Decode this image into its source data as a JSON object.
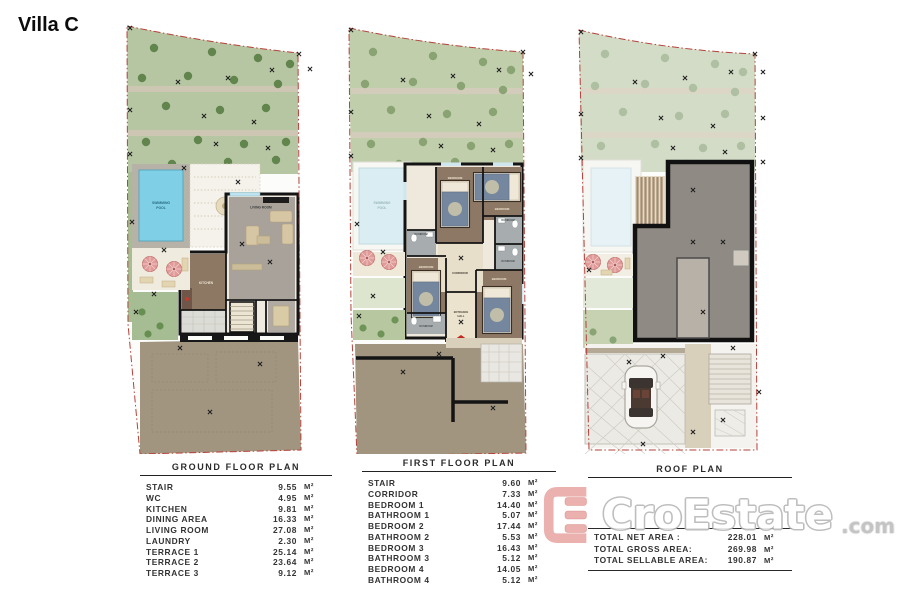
{
  "title": "Villa C",
  "colors": {
    "boundary_red": "#b5413a",
    "garden_green": "#b6c6a2",
    "tree_green": "#5d8248",
    "pool_blue": "#7fd0e6",
    "wood_floor_brown": "#8d7865",
    "living_gray": "#a8a29a",
    "driveway_tan": "#a19580",
    "roof_gray": "#8f8a84",
    "umbrella_pink": "#e09a98",
    "entrance_red": "#c4271f",
    "logo_pink": "#e8a7a3",
    "logo_gray": "#b6b6b6"
  },
  "plans": {
    "ground": {
      "labels": {
        "pool1": "SWIMMING",
        "pool2": "POOL",
        "living": "LIVING ROOM",
        "kitchen": "KITCHEN"
      }
    },
    "first": {
      "labels": {
        "pool1": "SWIMMING",
        "pool2": "POOL",
        "corridor": "CORRIDOR",
        "bedroom": "BEDROOM",
        "bathroom": "BATHROOM",
        "hall1": "ENTRANCE",
        "hall2": "HALL",
        "entrance": "ENTRANCE"
      }
    },
    "roof": {
      "labels": {}
    }
  },
  "tables": {
    "ground": {
      "title": "GROUND FLOOR PLAN",
      "rows": [
        {
          "name": "STAIR",
          "value": "9.55",
          "unit": "M²"
        },
        {
          "name": "WC",
          "value": "4.95",
          "unit": "M²"
        },
        {
          "name": "KITCHEN",
          "value": "9.81",
          "unit": "M²"
        },
        {
          "name": "DINING AREA",
          "value": "16.33",
          "unit": "M²"
        },
        {
          "name": "LIVING ROOM",
          "value": "27.08",
          "unit": "M²"
        },
        {
          "name": "LAUNDRY",
          "value": "2.30",
          "unit": "M²"
        },
        {
          "name": "TERRACE 1",
          "value": "25.14",
          "unit": "M²"
        },
        {
          "name": "TERRACE 2",
          "value": "23.64",
          "unit": "M²"
        },
        {
          "name": "TERRACE 3",
          "value": "9.12",
          "unit": "M²"
        }
      ]
    },
    "first": {
      "title": "FIRST FLOOR PLAN",
      "rows": [
        {
          "name": "STAIR",
          "value": "9.60",
          "unit": "M²"
        },
        {
          "name": "CORRIDOR",
          "value": "7.33",
          "unit": "M²"
        },
        {
          "name": "BEDROOM 1",
          "value": "14.40",
          "unit": "M²"
        },
        {
          "name": "BATHROOM 1",
          "value": "5.07",
          "unit": "M²"
        },
        {
          "name": "BEDROOM 2",
          "value": "17.44",
          "unit": "M²"
        },
        {
          "name": "BATHROOM 2",
          "value": "5.53",
          "unit": "M²"
        },
        {
          "name": "BEDROOM 3",
          "value": "16.43",
          "unit": "M²"
        },
        {
          "name": "BATHROOM 3",
          "value": "5.12",
          "unit": "M²"
        },
        {
          "name": "BEDROOM 4",
          "value": "14.05",
          "unit": "M²"
        },
        {
          "name": "BATHROOM 4",
          "value": "5.12",
          "unit": "M²"
        }
      ]
    },
    "roof": {
      "title": "ROOF PLAN",
      "totals": [
        {
          "name": "TOTAL NET AREA :",
          "value": "228.01",
          "unit": "M²"
        },
        {
          "name": "TOTAL GROSS AREA:",
          "value": "269.98",
          "unit": "M²"
        },
        {
          "name": "TOTAL SELLABLE AREA:",
          "value": "190.87",
          "unit": "M²"
        }
      ]
    }
  },
  "logo": {
    "text": "CroEstate",
    "suffix": ".com"
  }
}
